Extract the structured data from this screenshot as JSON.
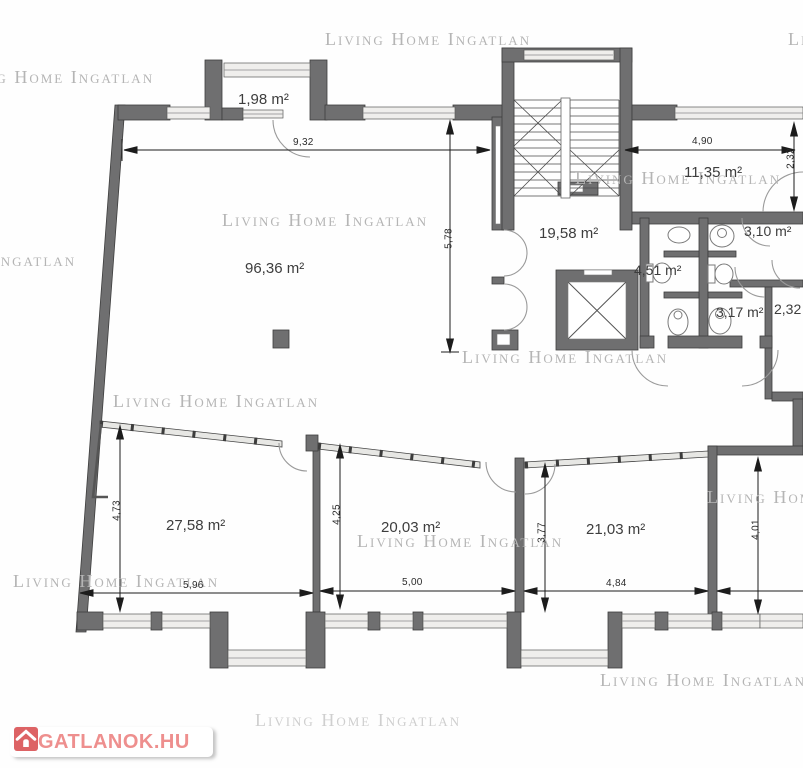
{
  "watermark": {
    "text": "Living Home Ingatlan"
  },
  "logo": {
    "text": "INGATLANOK.HU",
    "icon": "house-icon",
    "accent_red": "#dd6365",
    "text_red": "#ee8f8e"
  },
  "rooms": {
    "balcony": "1,98 m²",
    "living": "96,36 m²",
    "hall": "19,58 m²",
    "room_right_top": "11,35 m²",
    "wc_small_top": "3,10 m²",
    "bath_mid": "4,51 m²",
    "wc_small_bottom": "3,17 m²",
    "room_232": "2,32",
    "room_bottom_left": "27,58 m²",
    "room_bottom_mid": "20,03 m²",
    "room_bottom_right": "21,03 m²"
  },
  "dimensions": {
    "top_width": "9,32",
    "left_height": "5,78",
    "right_top_width": "4,90",
    "right_top_height": "2,32",
    "bl_height": "4,73",
    "bl_width": "5,96",
    "bm_height": "4,25",
    "bm_width": "5,00",
    "br_height": "3,77",
    "br_width": "4,84",
    "far_right_height": "4,01"
  },
  "colors": {
    "wall": "#6f6f70",
    "window": "#efeeec",
    "dimension_line": "#1c1c1c",
    "watermark_gray": "#b5b5b5"
  }
}
